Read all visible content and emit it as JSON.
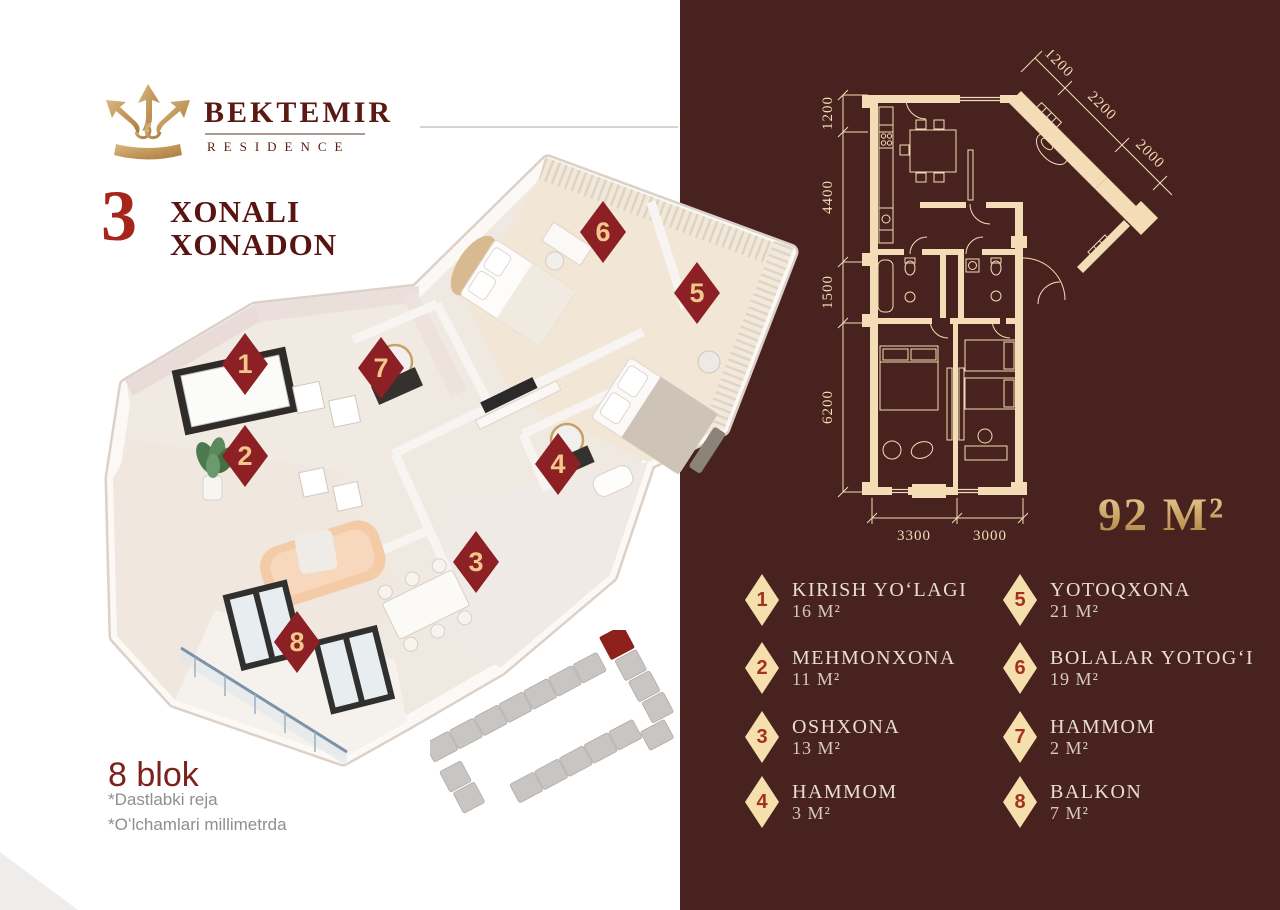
{
  "brand": {
    "name": "BEKTEMIR",
    "subtitle": "RESIDENCE"
  },
  "title": {
    "big_number": "3",
    "line1": "XONALI",
    "line2": "XONADON"
  },
  "block_info": {
    "name": "8 blok",
    "note1": "*Dastlabki reja",
    "note2": "*Oʻlchamlari millimetrda"
  },
  "total_area": "92 M²",
  "plan_2d": {
    "dims_left": [
      "1200",
      "4400",
      "1500",
      "6200"
    ],
    "dims_diagonal": [
      "1200",
      "2200",
      "2000"
    ],
    "dims_bottom": [
      "3300",
      "3000"
    ]
  },
  "markers": {
    "m1": "1",
    "m2": "2",
    "m3": "3",
    "m4": "4",
    "m5": "5",
    "m6": "6",
    "m7": "7",
    "m8": "8"
  },
  "legend": {
    "items": [
      {
        "num": "1",
        "label": "KIRISH YOʻLAGI",
        "area": "16 M²"
      },
      {
        "num": "2",
        "label": "MEHMONXONA",
        "area": "11 M²"
      },
      {
        "num": "3",
        "label": "OSHXONA",
        "area": "13 M²"
      },
      {
        "num": "4",
        "label": "HAMMOM",
        "area": "3 M²"
      },
      {
        "num": "5",
        "label": "YOTOQXONA",
        "area": "21 M²"
      },
      {
        "num": "6",
        "label": "BOLALAR YOTOGʻI",
        "area": "19 M²"
      },
      {
        "num": "7",
        "label": "HAMMOM",
        "area": "2 M²"
      },
      {
        "num": "8",
        "label": "BALKON",
        "area": "7 M²"
      }
    ]
  },
  "colors": {
    "panel": "#48221E",
    "plan_line": "#F4DCB6",
    "gold": "#C9A263",
    "legend_diamond": "#F5DFAC",
    "legend_number": "#A1321F",
    "marker_diamond": "#8C2024",
    "marker_number": "#F1C78A",
    "title_red": "#A6251B",
    "title_dark": "#571411"
  }
}
